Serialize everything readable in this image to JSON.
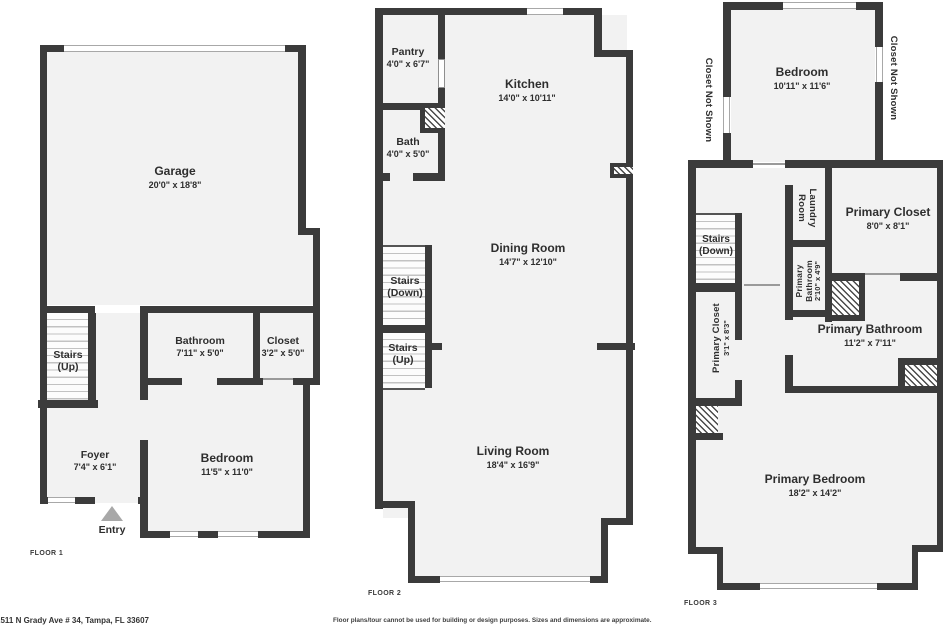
{
  "meta": {
    "address": "2511 N Grady Ave # 34, Tampa, FL 33607",
    "disclaimer": "Floor plans/tour cannot be used for building or design purposes. Sizes and dimensions are approximate."
  },
  "colors": {
    "wall": "#3b3b3b",
    "floor_fill": "#f2f2f2",
    "text": "#2e2e2e",
    "entry_arrow": "#a8a8a8"
  },
  "floor1": {
    "caption": "FLOOR 1",
    "garage": {
      "name": "Garage",
      "dims": "20'0\" x 18'8\""
    },
    "stairs": {
      "name": "Stairs",
      "dims": "(Up)"
    },
    "bathroom": {
      "name": "Bathroom",
      "dims": "7'11\" x 5'0\""
    },
    "closet": {
      "name": "Closet",
      "dims": "3'2\" x 5'0\""
    },
    "foyer": {
      "name": "Foyer",
      "dims": "7'4\" x 6'1\""
    },
    "bedroom": {
      "name": "Bedroom",
      "dims": "11'5\" x 11'0\""
    },
    "entry_label": "Entry"
  },
  "floor2": {
    "caption": "FLOOR 2",
    "pantry": {
      "name": "Pantry",
      "dims": "4'0\" x 6'7\""
    },
    "kitchen": {
      "name": "Kitchen",
      "dims": "14'0\" x 10'11\""
    },
    "bath": {
      "name": "Bath",
      "dims": "4'0\" x 5'0\""
    },
    "dining_room": {
      "name": "Dining Room",
      "dims": "14'7\" x 12'10\""
    },
    "stairs_down": {
      "name": "Stairs",
      "dims": "(Down)"
    },
    "stairs_up": {
      "name": "Stairs",
      "dims": "(Up)"
    },
    "living_room": {
      "name": "Living Room",
      "dims": "18'4\" x 16'9\""
    }
  },
  "floor3": {
    "caption": "FLOOR 3",
    "closet_not_shown_left": "Closet Not Shown",
    "closet_not_shown_right": "Closet Not Shown",
    "bedroom": {
      "name": "Bedroom",
      "dims": "10'11\" x 11'6\""
    },
    "laundry_room": {
      "line1": "Laundry",
      "line2": "Room"
    },
    "primary_closet_upper": {
      "name": "Primary Closet",
      "dims": "8'0\" x 8'1\""
    },
    "stairs_down": {
      "name": "Stairs",
      "dims": "(Down)"
    },
    "primary_bathroom_small": {
      "line1": "Primary",
      "line2": "Bathroom",
      "dims": "2'10\" x 4'9\""
    },
    "primary_closet_left": {
      "name": "Primary Closet",
      "dims": "3'1\" x 8'3\""
    },
    "primary_bathroom": {
      "name": "Primary Bathroom",
      "dims": "11'2\" x 7'11\""
    },
    "primary_bedroom": {
      "name": "Primary Bedroom",
      "dims": "18'2\" x 14'2\""
    }
  }
}
